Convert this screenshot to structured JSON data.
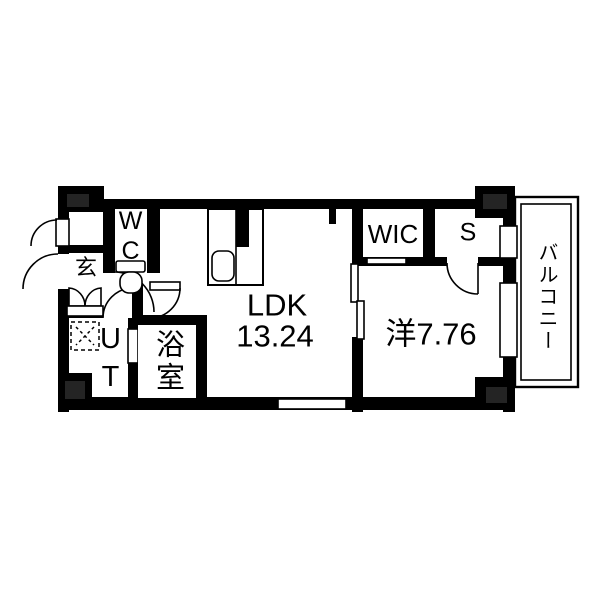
{
  "floorplan": {
    "type": "apartment-floor-plan",
    "colors": {
      "background": "#ffffff",
      "wall": "#000000",
      "column_inner": "#242424",
      "line": "#000000"
    },
    "rooms": {
      "ldk": {
        "label": "LDK",
        "area": "13.24"
      },
      "western_room": {
        "label": "洋7.76"
      },
      "walk_in_closet": {
        "label": "WIC"
      },
      "storage": {
        "label": "S"
      },
      "wc": {
        "label": "WC"
      },
      "genkan": {
        "label": "玄"
      },
      "utility": {
        "label": "UT"
      },
      "bathroom": {
        "label": "浴室"
      },
      "balcony": {
        "label": "バルコニー"
      }
    }
  }
}
